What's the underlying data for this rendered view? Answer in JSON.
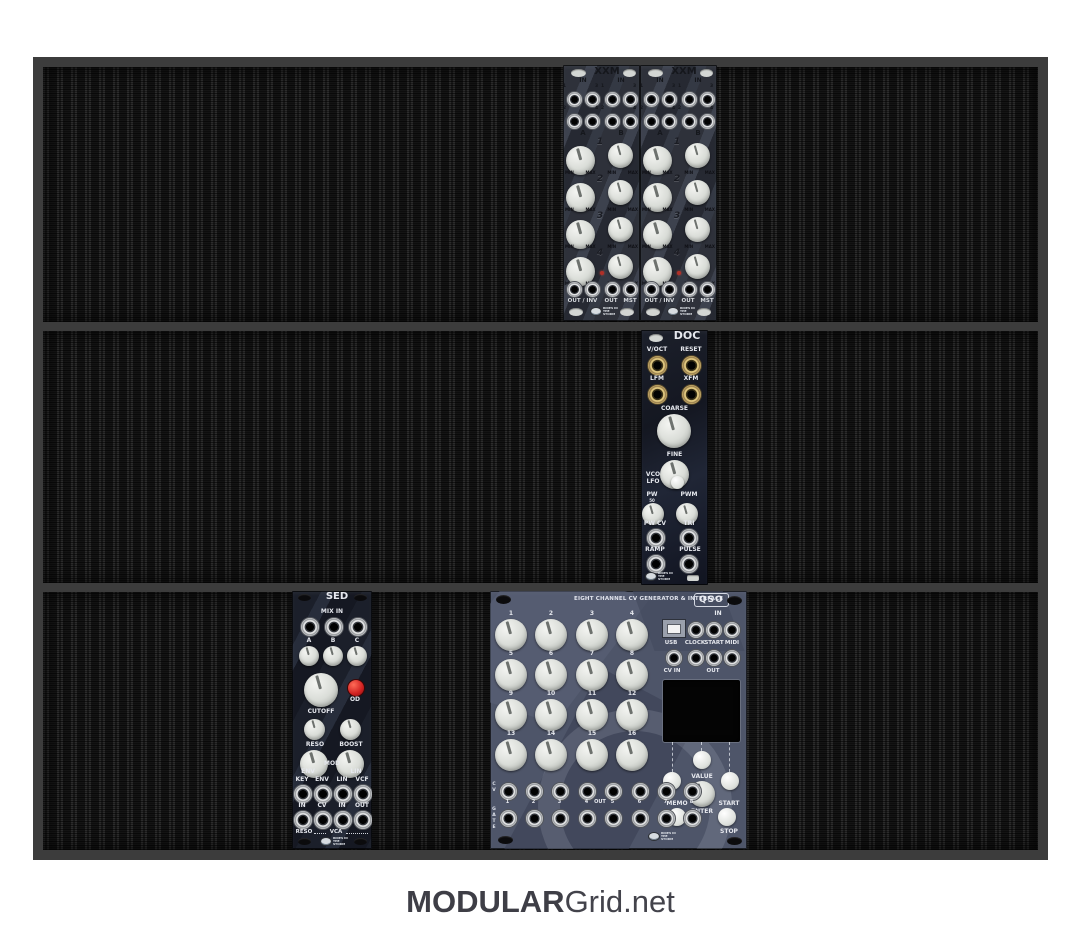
{
  "footer": {
    "brand_bold": "MODULAR",
    "brand_rest": "Grid.net"
  },
  "xxm": {
    "title": "XXM",
    "in_label": "IN",
    "jack_nums": [
      "1",
      "3",
      "2",
      "4"
    ],
    "group_a": "A",
    "group_b": "B",
    "channels": [
      "1",
      "2",
      "3",
      "4"
    ],
    "min": "MIN",
    "max": "MAX",
    "out_inv_label": "OUT / INV",
    "out_label": "OUT",
    "mst_label": "MST",
    "logo": "RIDES IN THE STORM"
  },
  "doc": {
    "title": "DOC",
    "voct": "V/OCT",
    "reset": "RESET",
    "lfm": "LFM",
    "xfm": "XFM",
    "coarse": "COARSE",
    "fine": "FINE",
    "vco": "VCO",
    "lfo": "LFO",
    "pw": "PW",
    "pw_fifty": "50",
    "pwm": "PWM",
    "pw_cv": "PW CV",
    "tri": "TRI",
    "ramp": "RAMP",
    "pulse": "PULSE",
    "logo": "RIDES IN THE STORM"
  },
  "sed": {
    "title": "SED",
    "mix_in": "MIX IN",
    "abc": [
      "A",
      "B",
      "C"
    ],
    "cutoff": "CUTOFF",
    "od": "OD",
    "reso": "RESO",
    "boost": "BOOST",
    "env": "ENV",
    "mod": "MOD",
    "lin": "LIN",
    "jacks_top": [
      "KEY",
      "ENV",
      "LIN",
      "VCF"
    ],
    "jacks_bottom": [
      "IN",
      "CV",
      "IN",
      "OUT"
    ],
    "reso_group": "RESO",
    "vca_group": "VCA",
    "logo": "RIDES IN THE STORM"
  },
  "qso": {
    "heading": "EIGHT CHANNEL CV GENERATOR & INTERFACE",
    "title": "QSO",
    "knobs": [
      "1",
      "2",
      "3",
      "4",
      "5",
      "6",
      "7",
      "8",
      "9",
      "10",
      "11",
      "12",
      "13",
      "14",
      "15",
      "16"
    ],
    "in_label": "IN",
    "usb": "USB",
    "clock": "CLOCK",
    "start": "START",
    "midi": "MIDI",
    "cv_in": "CV IN",
    "out_label": "OUT",
    "cv": "CV",
    "gate": "GATE",
    "out_nums": [
      "1",
      "2",
      "3",
      "4",
      "5",
      "6",
      "7",
      "8"
    ],
    "out_mid": "OUT",
    "value": "VALUE",
    "memo": "MEMO",
    "enter": "ENTER",
    "start_btn": "START",
    "stop": "STOP",
    "logo": "RIDES IN THE STORM"
  }
}
